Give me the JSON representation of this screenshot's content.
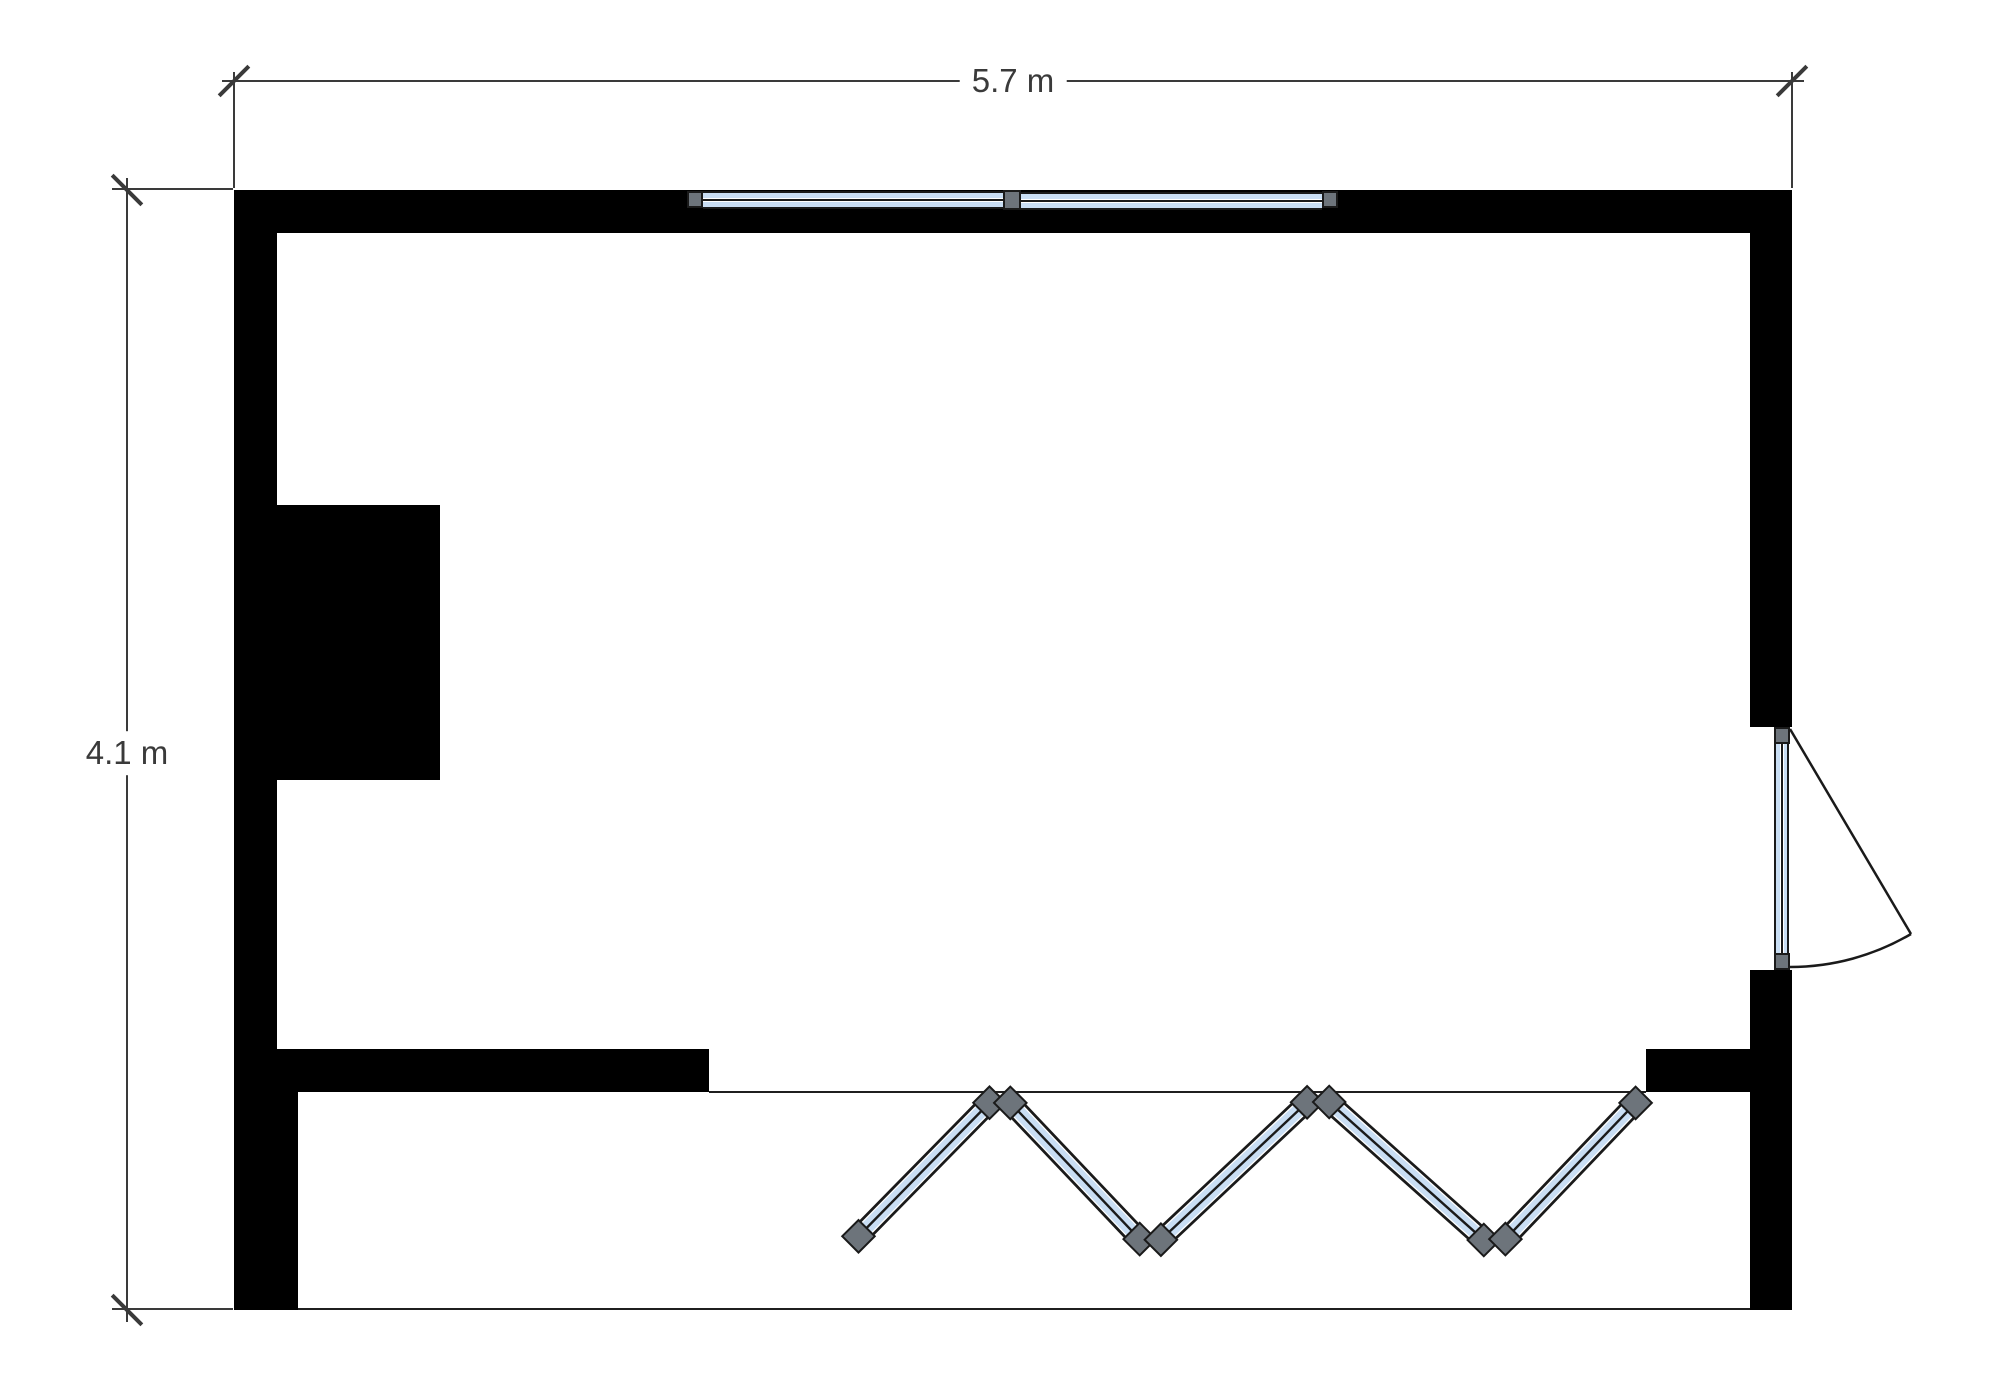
{
  "page": {
    "title": "Room floor plan",
    "type": "architectural-floor-plan"
  },
  "dimensions": {
    "width_label": "5.7 m",
    "height_label": "4.1 m"
  },
  "elements": {
    "top_window": {
      "kind": "double window",
      "sashes": 2
    },
    "right_door": {
      "kind": "glazed swing door",
      "wall": "right",
      "swing": "outward"
    },
    "folding_door": {
      "kind": "folding glass door",
      "panels": 5,
      "joints": 10
    },
    "chimney_block": {
      "kind": "solid block",
      "wall": "left"
    }
  },
  "colors": {
    "wall": "#000000",
    "background": "#ffffff",
    "glazing": "#c9def4",
    "frame_gray": "#6d747b",
    "outline": "#1a1a1a",
    "dimension": "#3a3a3a"
  }
}
